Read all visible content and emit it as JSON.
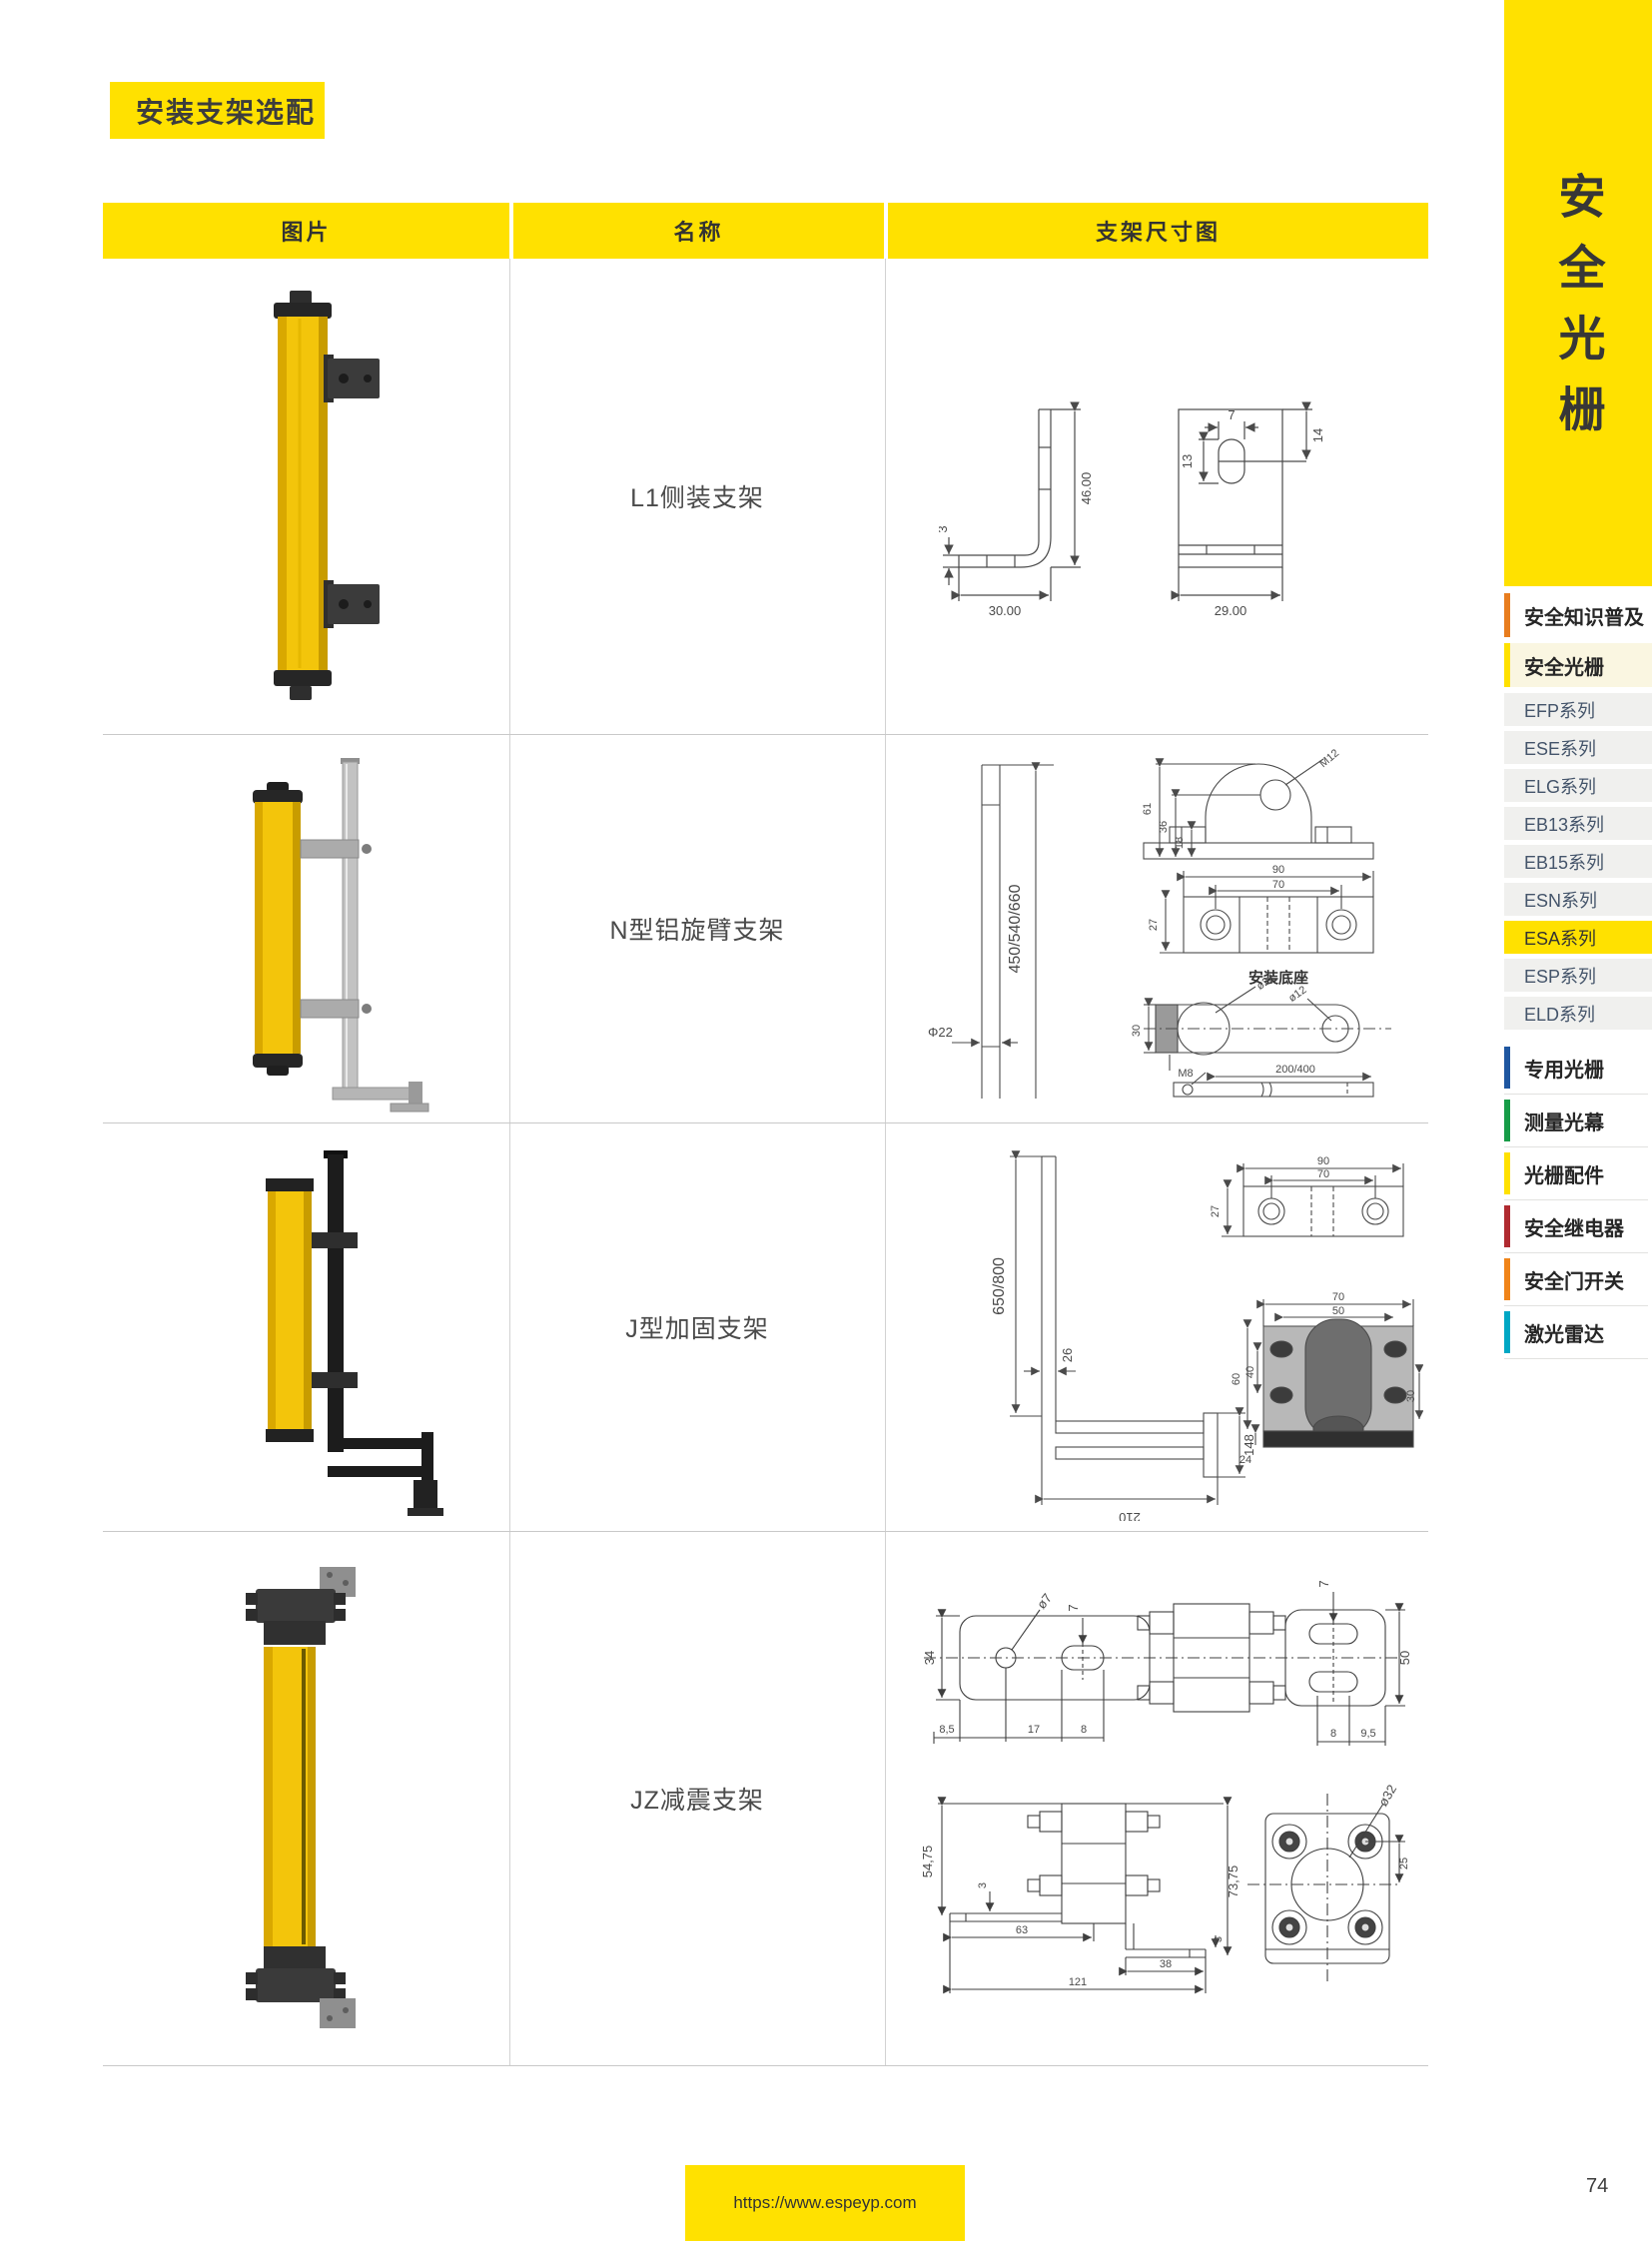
{
  "title_badge": "安装支架选配",
  "table": {
    "headers": [
      "图片",
      "名称",
      "支架尺寸图"
    ],
    "rows": [
      {
        "name": "L1侧装支架",
        "image": "yellow-light-curtain-with-two-side-brackets",
        "dims": {
          "height": "46.00",
          "width": "30.00",
          "thickness": "3",
          "slot_width": "7",
          "slot_height": "13",
          "slot_top": "14",
          "plate_width": "29.00"
        }
      },
      {
        "name": "N型铝旋臂支架",
        "image": "yellow-light-curtain-on-aluminum-pole",
        "dims": {
          "pole_length": "450/540/660",
          "pole_dia": "Φ22",
          "arch_h1": "61",
          "arch_h2": "36",
          "arch_h3": "18",
          "arch_thread": "M12",
          "plate_w_outer": "90",
          "plate_w_inner": "70",
          "plate_h": "27",
          "base_caption": "安装底座",
          "arm_w": "30",
          "arm_thread": "M8",
          "arm_dia1": "ø22",
          "arm_dia2": "ø12",
          "bar_length": "200/400"
        }
      },
      {
        "name": "J型加固支架",
        "image": "yellow-light-curtain-on-black-pole-with-arm",
        "dims": {
          "pole_length": "650/800",
          "pole_w": "26",
          "arm_h": "148",
          "base_w": "210",
          "plate_w_outer": "90",
          "plate_w_inner": "70",
          "plate_h": "27",
          "clamp_w_outer": "70",
          "clamp_w_inner": "50",
          "clamp_h_outer": "60",
          "clamp_h_inner": "40",
          "clamp_right": "30",
          "clamp_bottom": "24"
        }
      },
      {
        "name": "JZ减震支架",
        "image": "yellow-light-curtain-with-damper-mounts",
        "dims": {
          "hole_dia": "ø7",
          "slot_w_left": "7",
          "plate_h_left": "34",
          "off1": "8,5",
          "off2": "17",
          "off3": "8",
          "slot_w_right": "7",
          "plate_h_right": "50",
          "off4": "8",
          "off5": "9,5",
          "side_h_left": "54,75",
          "side_t_left": "3",
          "side_w1": "63",
          "side_w_total": "121",
          "side_w2": "38",
          "side_t_right": "3",
          "side_h_right": "73,75",
          "face_dia": "ø32",
          "face_off": "25"
        }
      }
    ]
  },
  "sidebar": {
    "banner_text": "安全光栅",
    "items": [
      {
        "label": "安全知识普及",
        "bar_color": "#E87D1E",
        "type": "category"
      },
      {
        "label": "安全光栅",
        "bar_color": "#FFE100",
        "type": "category",
        "active": true
      },
      {
        "label": "EFP系列",
        "type": "series"
      },
      {
        "label": "ESE系列",
        "type": "series"
      },
      {
        "label": "ELG系列",
        "type": "series"
      },
      {
        "label": "EB13系列",
        "type": "series"
      },
      {
        "label": "EB15系列",
        "type": "series"
      },
      {
        "label": "ESN系列",
        "type": "series"
      },
      {
        "label": "ESA系列",
        "type": "series",
        "active": true
      },
      {
        "label": "ESP系列",
        "type": "series"
      },
      {
        "label": "ELD系列",
        "type": "series"
      },
      {
        "label": "专用光栅",
        "bar_color": "#1E56A0",
        "type": "category"
      },
      {
        "label": "测量光幕",
        "bar_color": "#169C47",
        "type": "category"
      },
      {
        "label": "光栅配件",
        "bar_color": "#FFE100",
        "type": "category"
      },
      {
        "label": "安全继电器",
        "bar_color": "#B02A30",
        "type": "category"
      },
      {
        "label": "安全门开关",
        "bar_color": "#F08419",
        "type": "category"
      },
      {
        "label": "激光雷达",
        "bar_color": "#00A7C4",
        "type": "category"
      }
    ]
  },
  "footer": {
    "url": "https://www.espeyp.com",
    "page_number": "74"
  },
  "colors": {
    "accent_yellow": "#FFE100",
    "product_yellow": "#F3C50B",
    "series_text": "#44546A"
  }
}
